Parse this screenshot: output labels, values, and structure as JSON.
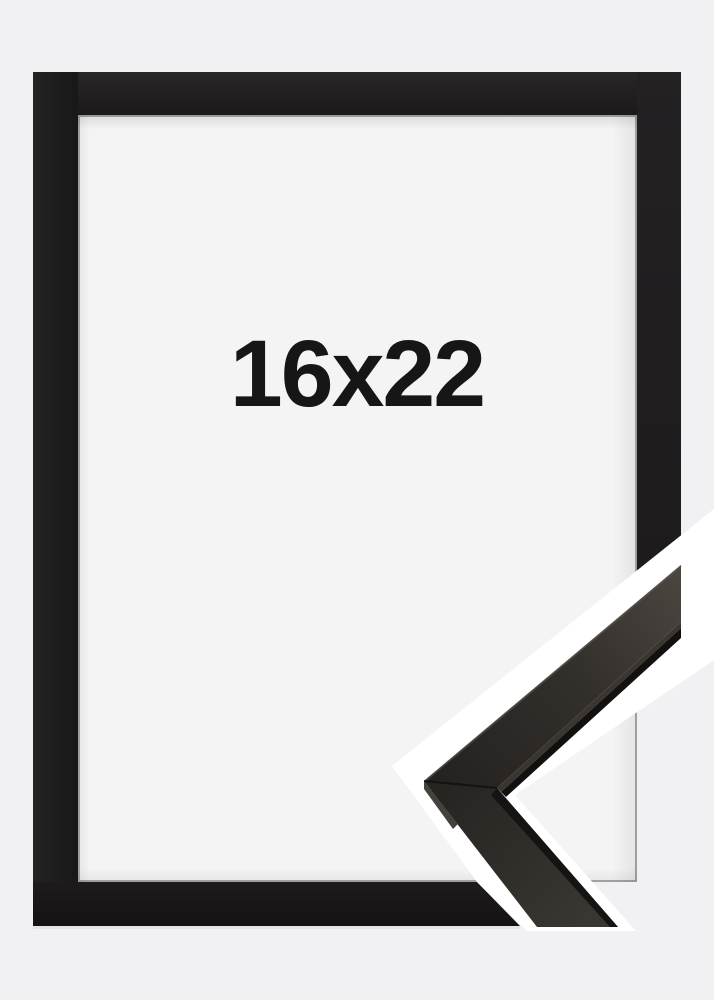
{
  "product_photo": {
    "size_label": "16x22"
  },
  "colors": {
    "background": "#f1f1f3",
    "frame": "#1e1c1d",
    "opening": "#f4f4f5",
    "cut_band": "#ffffff",
    "sample_face_light": "#4b4640",
    "sample_face_dark": "#242120",
    "label_text": "#161616"
  }
}
